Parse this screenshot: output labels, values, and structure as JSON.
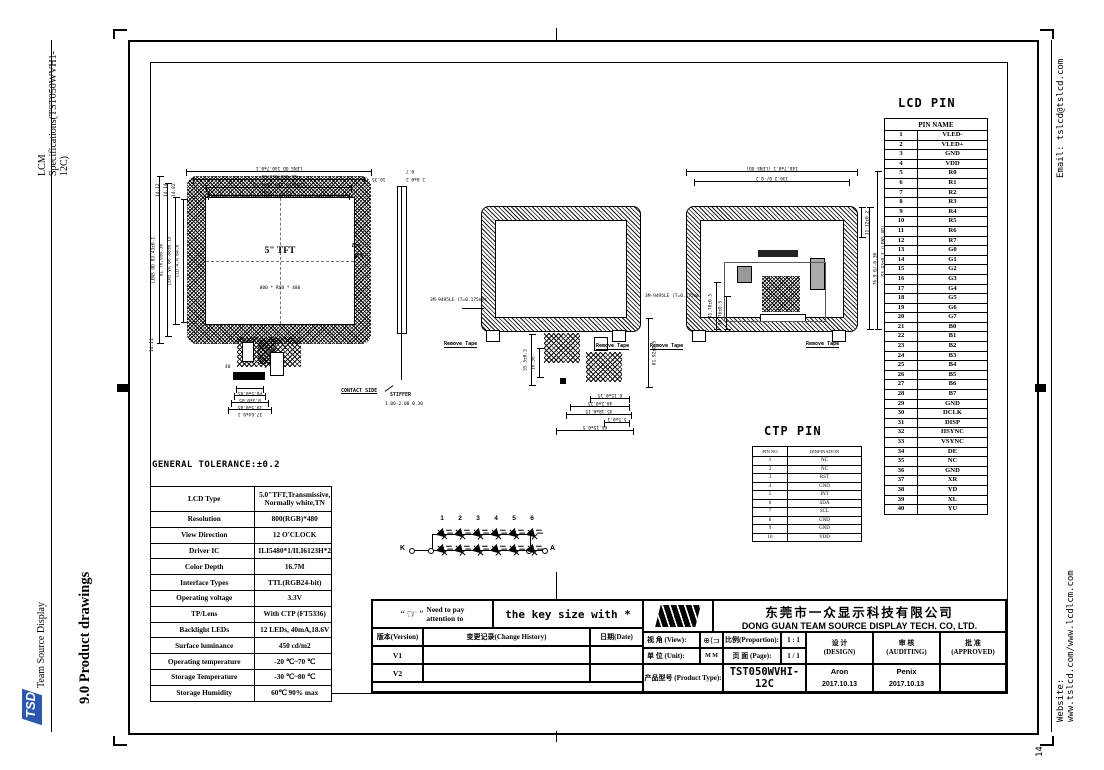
{
  "sidebar_left": {
    "spec_title": "LCM Specifications(TST050WVH1-12C)",
    "logo_text": "TSD",
    "company": "Team Source Display",
    "section_title": "9.0 Product drawings"
  },
  "sidebar_right": {
    "email": "Email: tslcd@tslcd.com",
    "website": "Website: www.tslcd.com/www.lcdlcm.com",
    "page_number": "14"
  },
  "lcd_pin": {
    "title": "LCD PIN",
    "header": "PIN NAME",
    "rows": [
      [
        "1",
        "VLED-"
      ],
      [
        "2",
        "VLED+"
      ],
      [
        "3",
        "GND"
      ],
      [
        "4",
        "VDD"
      ],
      [
        "5",
        "R0"
      ],
      [
        "6",
        "R1"
      ],
      [
        "7",
        "R2"
      ],
      [
        "8",
        "R3"
      ],
      [
        "9",
        "R4"
      ],
      [
        "10",
        "R5"
      ],
      [
        "11",
        "R6"
      ],
      [
        "12",
        "R7"
      ],
      [
        "13",
        "G0"
      ],
      [
        "14",
        "G1"
      ],
      [
        "15",
        "G2"
      ],
      [
        "16",
        "G3"
      ],
      [
        "17",
        "G4"
      ],
      [
        "18",
        "G5"
      ],
      [
        "19",
        "G6"
      ],
      [
        "20",
        "G7"
      ],
      [
        "21",
        "B0"
      ],
      [
        "22",
        "B1"
      ],
      [
        "23",
        "B2"
      ],
      [
        "24",
        "B3"
      ],
      [
        "25",
        "B4"
      ],
      [
        "26",
        "B5"
      ],
      [
        "27",
        "B6"
      ],
      [
        "28",
        "B7"
      ],
      [
        "29",
        "GND"
      ],
      [
        "30",
        "DCLK"
      ],
      [
        "31",
        "DISP"
      ],
      [
        "32",
        "HSYNC"
      ],
      [
        "33",
        "VSYNC"
      ],
      [
        "34",
        "DE"
      ],
      [
        "35",
        "NC"
      ],
      [
        "36",
        "GND"
      ],
      [
        "37",
        "XR"
      ],
      [
        "38",
        "YD"
      ],
      [
        "39",
        "XL"
      ],
      [
        "40",
        "YU"
      ]
    ]
  },
  "ctp_pin": {
    "title": "CTP PIN",
    "headers": [
      "PIN NO",
      "DINFINATION"
    ],
    "rows": [
      [
        "1",
        "NC"
      ],
      [
        "2",
        "NC"
      ],
      [
        "3",
        "RST"
      ],
      [
        "4",
        "GND"
      ],
      [
        "5",
        "INT"
      ],
      [
        "6",
        "SDA"
      ],
      [
        "7",
        "SCL"
      ],
      [
        "8",
        "GND"
      ],
      [
        "9",
        "GND"
      ],
      [
        "10",
        "VDD"
      ]
    ]
  },
  "tolerance": {
    "title": "GENERAL TOLERANCE:±0.2",
    "rows": [
      [
        "LCD Type",
        "5.0\"TFT,Transmissive,\nNormally white,TN"
      ],
      [
        "Resolution",
        "800(RGB)*480"
      ],
      [
        "View Direction",
        "12 O'CLOCK"
      ],
      [
        "Driver IC",
        "ILI5480*1/ILI6123H*2"
      ],
      [
        "Color Depth",
        "16.7M"
      ],
      [
        "Interface Types",
        "TTL(RGB24-bit)"
      ],
      [
        "Operating voltage",
        "3.3V"
      ],
      [
        "TP/Lens",
        "With CTP (FT5336)"
      ],
      [
        "Backlight LEDs",
        "12 LEDs, 40mA,18.6V"
      ],
      [
        "Surface luminance",
        "450 cd/m2"
      ],
      [
        "Operating temperature",
        "-20 ℃~70 ℃"
      ],
      [
        "Storage Temperature",
        "-30 ℃~80 ℃"
      ],
      [
        "Storage Humidity",
        "60℃ 90% max"
      ]
    ]
  },
  "title_block": {
    "quote_open": "“",
    "hand": "☞",
    "quote_close": "”",
    "attention": "Need to pay\nattention to",
    "key_size": "the key size with *",
    "version_label": "版本(Version)",
    "history_label": "变更记录(Change History)",
    "date_label": "日期(Date)",
    "v1": "V1",
    "v2": "V2",
    "company_cn": "东莞市一众显示科技有限公司",
    "company_en": "DONG GUAN TEAM SOURCE DISPLAY TECH. CO, LTD.",
    "view_label": "视 角 (View):",
    "view_symbol": "⊕⟨⊐",
    "proportion_label": "比例(Proportion):",
    "proportion_value": "1 : 1",
    "unit_label": "单 位 (Unit):",
    "unit_value": "M M",
    "page_label": "页 面 (Page):",
    "page_value": "1 / 1",
    "product_label": "产品型号 (Product Type):",
    "product_value": "TST050WVHI-12C",
    "design_label": "设 计\n(DESIGN)",
    "auditing_label": "审 核\n(AUDITING)",
    "approved_label": "批 准\n(APPROVED)",
    "designer": "Aron",
    "design_date": "2017.10.13",
    "auditor": "Penix",
    "audit_date": "2017.10.13"
  },
  "drawings": {
    "front": {
      "label": "5\" TFT",
      "sub_label": "800 * RGB * 480",
      "top_dims": [
        "LENS OD 140.7±0.1",
        "BL 130.6±0.30",
        "LENS VA 108.08±0.15",
        "LCD A.A 108"
      ],
      "left_dims": [
        "LENS OD 83.43±0.1",
        "BL 76.9±0.30",
        "LENS VA 66.88±0.15",
        "LCD A.A 64.8"
      ],
      "corner_dims": [
        "14.12",
        "14.14",
        "14.82"
      ],
      "right_dim": "10.35",
      "bottom_left_dim": "14.11",
      "pin40": "40",
      "pin1": "1",
      "ctp10": "10",
      "ctp1": "1",
      "connector_dims": [
        "P0.5±0.05",
        "0.3±0.05",
        "19.5±0.05",
        "37.64±0.1"
      ]
    },
    "side": {
      "top_dims": [
        "0.7",
        "2.0±0.2"
      ],
      "eye": "Eye",
      "contact_side": "CONTACT SIDE",
      "stiffer": "STIFFER",
      "stiffer_dims": "1.00-2.00\n0.30"
    },
    "back1": {
      "tape_label": "3M-9495LE\n(T=0.175mm)",
      "remove_tape": "Remove Tape",
      "left_dims": [
        "35.3±0.3",
        "16.56"
      ],
      "right_dim": "81.92±0.5",
      "bottom_dims": [
        "6.15±0.15",
        "40.2±0.25",
        "45.18±0.15",
        "5.5±0.1",
        "66.15±0.5"
      ]
    },
    "back2": {
      "tape_label": "3M-9495LE\n(T=0.175mm)",
      "remove_tape": "Remove Tape",
      "top_dims": [
        "146.7±0.1 (LENS OD)",
        "130.2 0/-0.2"
      ],
      "right_dims": [
        "11.12±0.2",
        "76.9 0/-0.30",
        "83.43±0.1 (LENS OD)"
      ],
      "inner_dims": [
        "41.78±0.5",
        "36.76±0.5"
      ]
    },
    "led_circuit": {
      "numbers": [
        "1",
        "2",
        "3",
        "4",
        "5",
        "6"
      ],
      "cathode": "K",
      "anode": "A"
    }
  }
}
